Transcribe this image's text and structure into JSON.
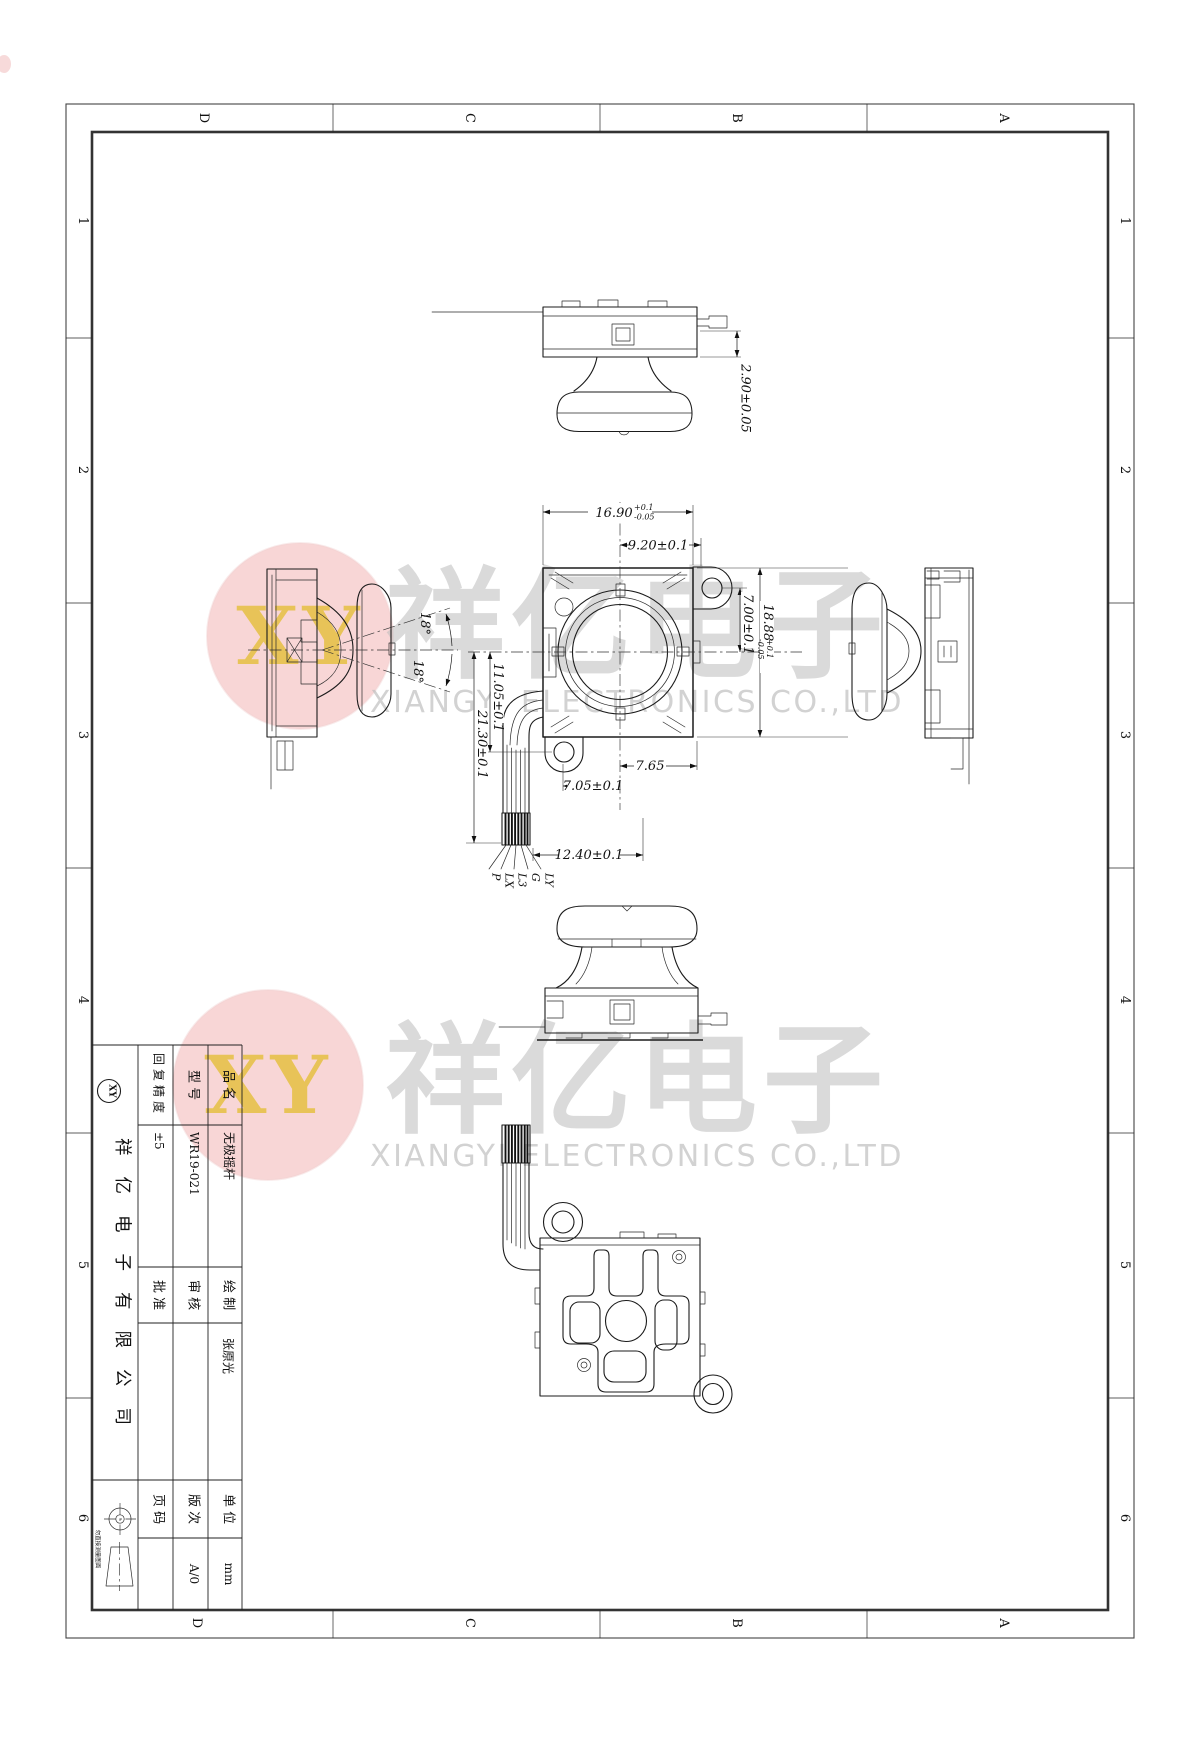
{
  "sheet": {
    "zones": {
      "letters": [
        "D",
        "C",
        "B",
        "A"
      ],
      "numbers": [
        "1",
        "2",
        "3",
        "4",
        "5",
        "6"
      ]
    },
    "dims": {
      "cap_h": "2.90±0.05",
      "w": "16.90",
      "w_tp": "+0.1",
      "w_tm": "-0.05",
      "d920": "9.20±0.1",
      "d700": "7.00±0.1",
      "h": "18.88",
      "h_tp": "+0.1",
      "h_tm": "-0.05",
      "d1105": "11.05±0.1",
      "d2130": "21.30±0.1",
      "d765": "7.65",
      "d705": "7.05±0.1",
      "d1240": "12.40±0.1",
      "ang_u": "18°",
      "ang_d": "18°"
    },
    "wires": [
      "P",
      "LX",
      "L3",
      "G",
      "LY"
    ],
    "watermark": {
      "cn": "祥亿电子",
      "en": "XIANGYI ELECTRONICS CO.,LTD",
      "logo": "XY",
      "stamp_fill": "#e77070",
      "logo_text_color": "#e7c24b"
    },
    "tb": {
      "product_label": "品 名",
      "product": "无极摇杆",
      "model_label": "型 号",
      "model": "WR19-021",
      "precision_label": "回复精度",
      "precision": "±5",
      "drawn_label": "绘 制",
      "drawn": "张原光",
      "checked_label": "审 核",
      "checked": "",
      "approved_label": "批 准",
      "approved": "",
      "unit_label": "单 位",
      "unit": "mm",
      "rev_label": "版 次",
      "rev": "A/0",
      "page_label": "页 码",
      "page": "",
      "company": "祥亿电子有限公司",
      "caution": "勿直接测量图面",
      "logo": "XY"
    }
  }
}
